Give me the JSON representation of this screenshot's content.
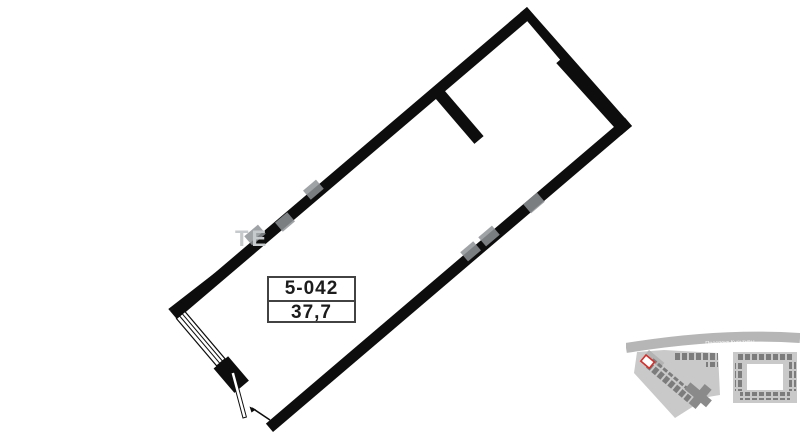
{
  "plan": {
    "unit_number": "5-042",
    "area": "37,7"
  },
  "watermark": {
    "visible_letters": "ТЕ"
  },
  "minimap": {
    "road_label": "Проспект Культуры"
  },
  "colors": {
    "wall": "#0d0d0d",
    "accent-red": "#d0312d",
    "road": "#b6b6b6",
    "footprint": "#c9c9c9",
    "units": "#7c7c7c",
    "watermark": "#8f9396",
    "watermark-light": "#c7cacc",
    "label-border": "#424242",
    "text": "#1c1c1c"
  }
}
